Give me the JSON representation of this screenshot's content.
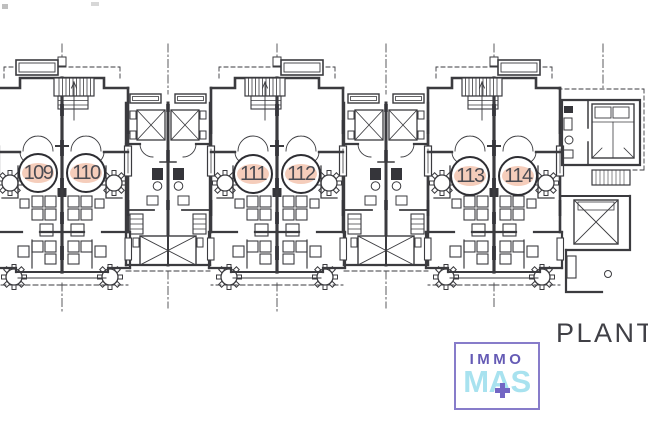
{
  "plan": {
    "label": "PLANTA",
    "units": [
      {
        "number": "109"
      },
      {
        "number": "110"
      },
      {
        "number": "111"
      },
      {
        "number": "112"
      },
      {
        "number": "113"
      },
      {
        "number": "114"
      }
    ],
    "unit_highlight_color": "#f5cdbb",
    "line_color": "#3b3b3f",
    "title_color": "#404046"
  },
  "logo": {
    "top": "IMMO",
    "bottom": "MAS",
    "plus_icon": "+",
    "border_color": "#877cca",
    "top_color": "#655bb5",
    "bottom_color": "#a8e2ef",
    "plus_color": "#7366c4"
  }
}
